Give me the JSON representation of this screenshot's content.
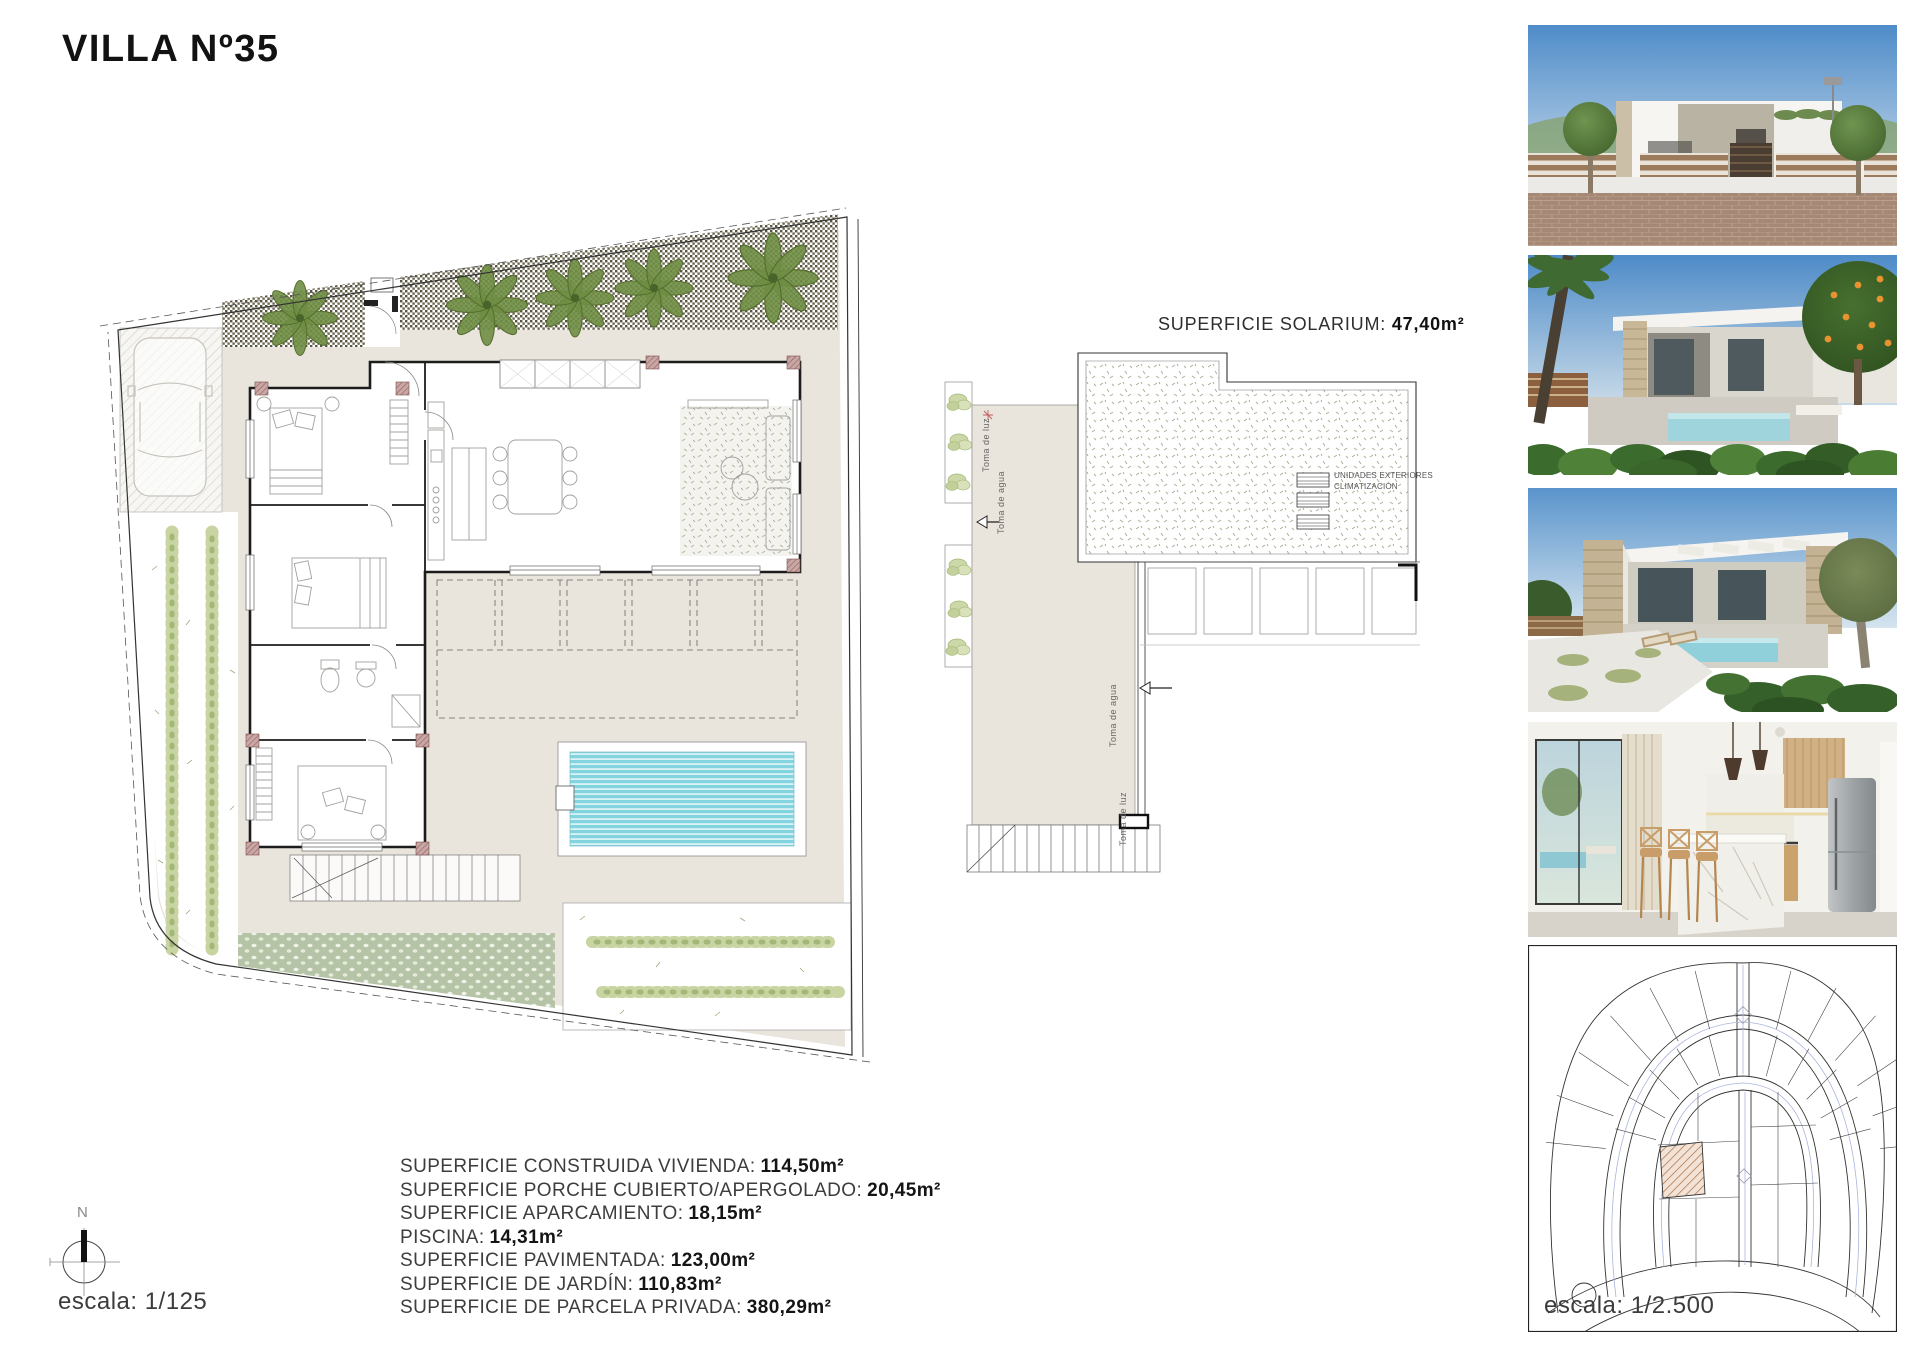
{
  "page": {
    "title": "VILLA Nº35"
  },
  "ground_plan": {
    "north_label": "N",
    "scale_label": "escala: 1/125"
  },
  "roof_plan": {
    "title_label": "SUPERFICIE SOLARIUM:",
    "title_value": "47,40m²",
    "ac_line1": "UNIDADES EXTERIORES",
    "ac_line2": "CLIMATIZACIÓN",
    "water_label": "Toma de agua",
    "power_label": "Toma de luz"
  },
  "areas": [
    {
      "label": "SUPERFICIE CONSTRUIDA VIVIENDA:",
      "value": "114,50m²"
    },
    {
      "label": "SUPERFICIE PORCHE CUBIERTO/APERGOLADO:",
      "value": "20,45m²"
    },
    {
      "label": "SUPERFICIE APARCAMIENTO:",
      "value": "18,15m²"
    },
    {
      "label": "PISCINA:",
      "value": "14,31m²"
    },
    {
      "label": "SUPERFICIE PAVIMENTADA:",
      "value": "123,00m²"
    },
    {
      "label": "SUPERFICIE DE JARDÍN:",
      "value": "110,83m²"
    },
    {
      "label": "SUPERFICIE DE PARCELA PRIVADA:",
      "value": "380,29m²"
    }
  ],
  "site_plan": {
    "scale_label": "escala: 1/2.500"
  },
  "colors": {
    "paving_beige": "#e9e4dc",
    "pool_cyan": "#82d5df",
    "hedge_green": "#c8d5a2",
    "palm_green": "#6f8e44",
    "gravel_dark": "#57543f",
    "garden_strip_green": "#b5c3a6",
    "pillar_red": "#b98f8f",
    "wall_black": "#1c1c1c",
    "sky_blue": "#6aa0d4"
  }
}
